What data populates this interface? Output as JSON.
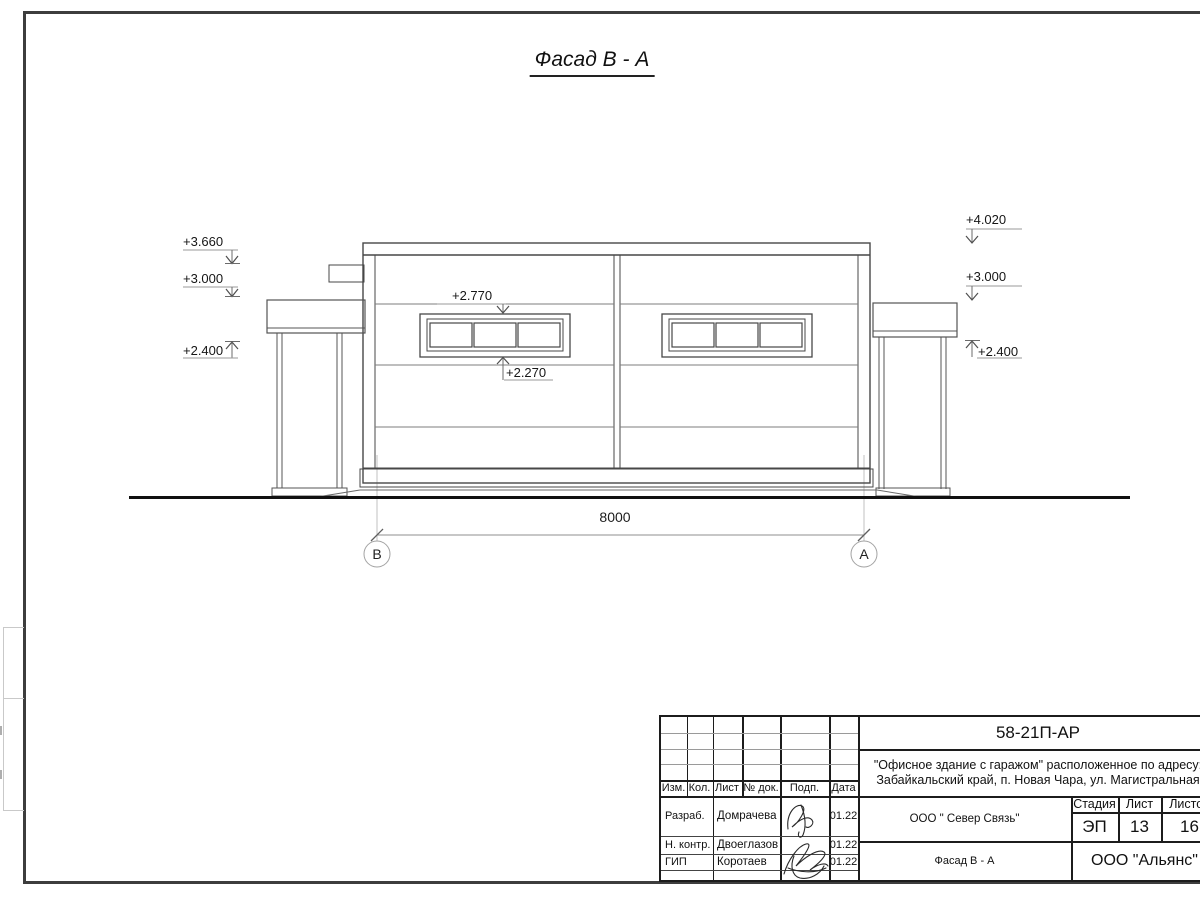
{
  "drawing": {
    "title": "Фасад В - А",
    "elevations": {
      "left": [
        "+3.660",
        "+3.000",
        "+2.400"
      ],
      "right": [
        "+4.020",
        "+3.000",
        "+2.400"
      ],
      "window_top": "+2.770",
      "window_bottom": "+2.270"
    },
    "dimension": "8000",
    "axes": [
      "В",
      "А"
    ]
  },
  "title_block": {
    "doc_number": "58-21П-АР",
    "project_address_line1": "\"Офисное здание с гаражом\" расположенное по адресу:",
    "project_address_line2": "Забайкальский край, п. Новая Чара, ул. Магистральная",
    "columns": {
      "izm": "Изм.",
      "kol": "Кол.",
      "list": "Лист",
      "doc_num": "№ док.",
      "podp": "Подп.",
      "data": "Дата"
    },
    "staff": [
      {
        "role": "Разраб.",
        "name": "Домрачева",
        "date": "01.22"
      },
      {
        "role": "Н. контр.",
        "name": "Двоеглазов",
        "date": "01.22"
      },
      {
        "role": "ГИП",
        "name": "Коротаев",
        "date": "01.22"
      }
    ],
    "contractor": "ООО \" Север Связь\"",
    "stage_label": "Стадия",
    "sheet_label": "Лист",
    "sheets_label": "Листов",
    "stage": "ЭП",
    "sheet_number": "13",
    "sheets_total": "16",
    "view_title": "Фасад В - А",
    "organization": "ООО \"Альянс\""
  }
}
